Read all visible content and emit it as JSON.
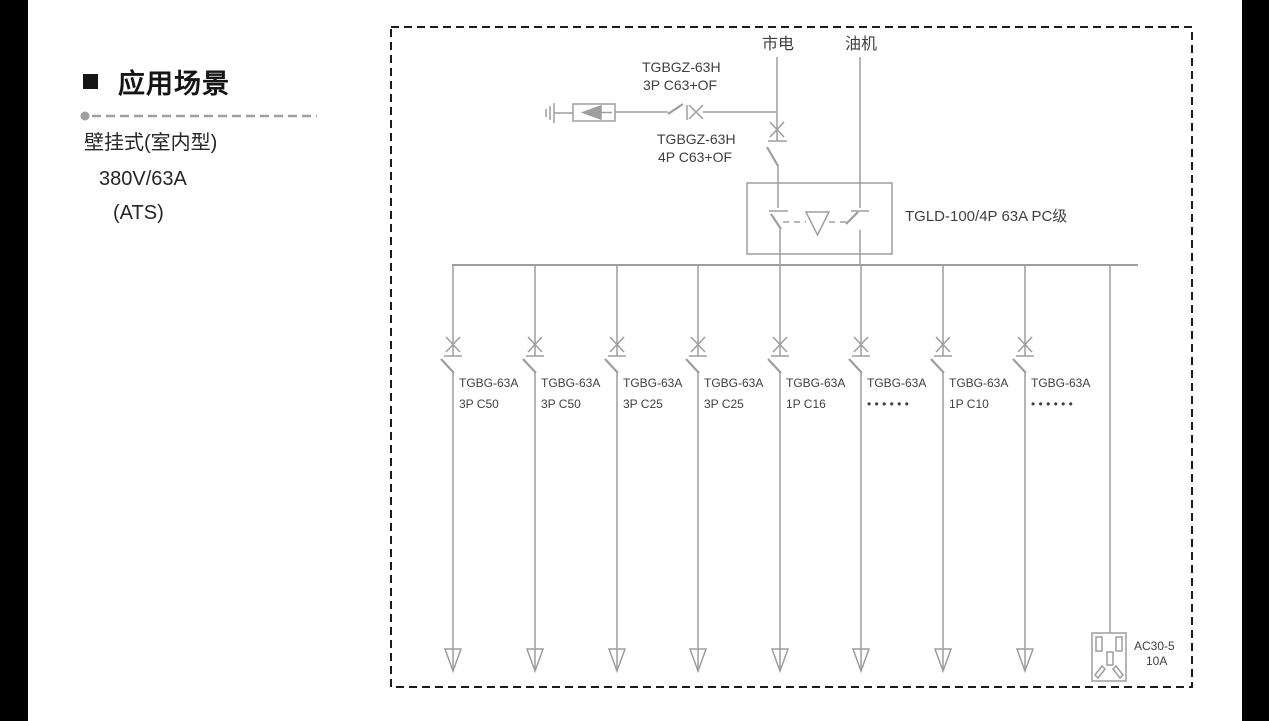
{
  "colors": {
    "line": "#9e9e9e",
    "diagram_text": "#3f3f3f",
    "border_black": "#1c1c1c",
    "divider_gray": "#a0a0a0"
  },
  "sidebar": {
    "heading": "应用场景",
    "line1": "壁挂式(室内型)",
    "line2": "380V/63A",
    "line3": "(ATS)"
  },
  "diagram": {
    "mains_label": "市电",
    "generator_label": "油机",
    "spd_breaker_line1": "TGBGZ-63H",
    "spd_breaker_line2": "3P C63+OF",
    "main_breaker_line1": "TGBGZ-63H",
    "main_breaker_line2": "4P C63+OF",
    "ats_label": "TGLD-100/4P 63A PC级",
    "branches": [
      {
        "model": "TGBG-63A",
        "spec": "3P C50"
      },
      {
        "model": "TGBG-63A",
        "spec": "3P C50"
      },
      {
        "model": "TGBG-63A",
        "spec": "3P C25"
      },
      {
        "model": "TGBG-63A",
        "spec": "3P C25"
      },
      {
        "model": "TGBG-63A",
        "spec": "1P C16"
      },
      {
        "model": "TGBG-63A",
        "spec": "• • • • • •"
      },
      {
        "model": "TGBG-63A",
        "spec": "1P C10"
      },
      {
        "model": "TGBG-63A",
        "spec": "• • • • • •"
      }
    ],
    "socket_model": "AC30-5",
    "socket_rating": "10A"
  }
}
